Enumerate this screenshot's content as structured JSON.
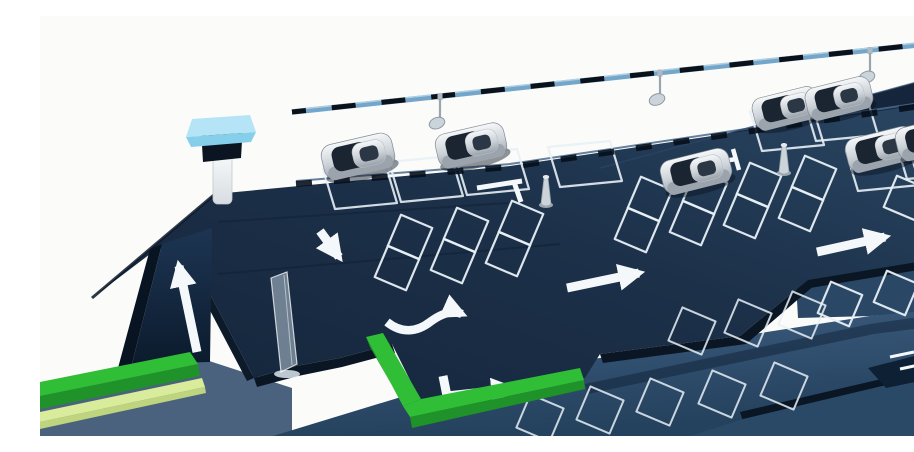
{
  "scene": {
    "name": "3d-parking-facility-illustration",
    "width": 914,
    "height": 420,
    "colors": {
      "bg": "#fbfbf9",
      "deck_face": "#0a1624",
      "marking": "#f4f8fb",
      "space_stroke": "#e8f0f6",
      "rail_bar": "#74a6ca",
      "rail_highlight": "#b6d4e8",
      "rail_dash": "#0b1119",
      "fixture_metal": "#ccd4db",
      "fixture_stroke": "#8e99a3",
      "kiosk_cap": "#b5e4f6",
      "kiosk_cap_rim": "#86cfeb",
      "kiosk_screen": "#0b1522",
      "bollard_body": "#ccd3d9",
      "bollard_stroke": "#99a3ad",
      "car_glass": "#1a2531",
      "car_skirt": "#9ba3ac",
      "curb_green": "#2fbe36",
      "curb_green_dark": "#1f9229",
      "curb_stripe": "#d9ec9b",
      "curb_stripe_dark": "#bed47e",
      "glass_gate": "rgba(214,232,244,0.45)"
    },
    "polygons": [
      {
        "name": "ground-slab",
        "fill": "#4a627d",
        "pts": [
          [
            0,
            376
          ],
          [
            160,
            342
          ],
          [
            252,
            372
          ],
          [
            252,
            420
          ],
          [
            0,
            420
          ]
        ]
      },
      {
        "name": "lower-deck",
        "fill": "g:glower",
        "pts": [
          [
            233,
            420
          ],
          [
            430,
            360
          ],
          [
            560,
            342
          ],
          [
            830,
            300
          ],
          [
            914,
            290
          ],
          [
            914,
            420
          ]
        ]
      },
      {
        "name": "deck-shadow",
        "fill": "#0d1d30",
        "opacity": 0.45,
        "pts": [
          [
            545,
            368
          ],
          [
            830,
            308
          ],
          [
            914,
            296
          ],
          [
            914,
            308
          ],
          [
            834,
            318
          ],
          [
            548,
            378
          ]
        ]
      },
      {
        "name": "lower-front-band",
        "fill": "#0a1624",
        "pts": [
          [
            700,
            396
          ],
          [
            914,
            346
          ],
          [
            914,
            355
          ],
          [
            703,
            405
          ]
        ]
      },
      {
        "name": "lower-bottom-deck",
        "fill": "#2a4967",
        "pts": [
          [
            650,
            420
          ],
          [
            703,
            403
          ],
          [
            914,
            353
          ],
          [
            914,
            420
          ]
        ]
      },
      {
        "name": "bottom-right-wedge",
        "fill": "#0e2034",
        "pts": [
          [
            828,
            352
          ],
          [
            913,
            330
          ],
          [
            914,
            358
          ],
          [
            846,
            372
          ]
        ]
      },
      {
        "name": "mid-right-deck",
        "fill": "#2a4765",
        "pts": [
          [
            756,
            266
          ],
          [
            914,
            236
          ],
          [
            914,
            292
          ],
          [
            830,
            300
          ],
          [
            758,
            302
          ]
        ]
      },
      {
        "name": "back-deck-strip",
        "fill": "#15263c",
        "pts": [
          [
            560,
            152
          ],
          [
            914,
            56
          ],
          [
            914,
            98
          ],
          [
            560,
            194
          ]
        ]
      },
      {
        "name": "upper-deck",
        "fill": "g:gdeck",
        "pts": [
          [
            52,
            282
          ],
          [
            175,
            178
          ],
          [
            470,
            150
          ],
          [
            914,
            84
          ],
          [
            914,
            240
          ],
          [
            838,
            256
          ],
          [
            768,
            264
          ],
          [
            700,
            320
          ],
          [
            560,
            338
          ],
          [
            545,
            362
          ],
          [
            388,
            400
          ],
          [
            352,
            328
          ],
          [
            300,
            342
          ],
          [
            256,
            350
          ],
          [
            214,
            362
          ],
          [
            150,
            240
          ],
          [
            118,
            232
          ]
        ]
      },
      {
        "name": "deck-face-a",
        "fill": "#0a1624",
        "pts": [
          [
            214,
            362
          ],
          [
            256,
            350
          ],
          [
            300,
            342
          ],
          [
            352,
            328
          ],
          [
            355,
            337
          ],
          [
            302,
            351
          ],
          [
            258,
            360
          ],
          [
            217,
            371
          ]
        ]
      },
      {
        "name": "deck-face-b",
        "fill": "#0a1624",
        "pts": [
          [
            560,
            338
          ],
          [
            700,
            320
          ],
          [
            768,
            264
          ],
          [
            776,
            268
          ],
          [
            706,
            328
          ],
          [
            563,
            347
          ]
        ]
      },
      {
        "name": "deck-face-c",
        "fill": "#0a1624",
        "pts": [
          [
            768,
            264
          ],
          [
            914,
            240
          ],
          [
            914,
            248
          ],
          [
            770,
            272
          ]
        ]
      },
      {
        "name": "gate-slab-edge",
        "fill": "#0c1a2a",
        "pts": [
          [
            150,
            240
          ],
          [
            214,
            362
          ],
          [
            207,
            365
          ],
          [
            143,
            243
          ]
        ]
      },
      {
        "name": "ramp-side",
        "fill": "#091423",
        "pts": [
          [
            92,
            348
          ],
          [
            122,
            228
          ],
          [
            110,
            233
          ],
          [
            78,
            352
          ]
        ]
      },
      {
        "name": "ramp",
        "fill": "g:gramp",
        "pts": [
          [
            92,
            348
          ],
          [
            122,
            228
          ],
          [
            172,
            212
          ],
          [
            170,
            346
          ]
        ]
      }
    ],
    "lines": [
      {
        "name": "left-edge-shadow",
        "d": "M52,282 L175,178",
        "stroke": "#0c1a2a",
        "w": 3,
        "opacity": 0.85
      },
      {
        "name": "deck-seam-1",
        "d": "M178,258 L520,228",
        "stroke": "#0f2033",
        "w": 2,
        "opacity": 0.55
      },
      {
        "name": "deck-seam-2",
        "d": "M178,206 L468,187",
        "stroke": "#0f2033",
        "w": 2,
        "opacity": 0.5
      },
      {
        "name": "deck-edge-rim",
        "d": "M256,165 L470,148 L914,82",
        "stroke": "#4a6b8d",
        "w": 2,
        "opacity": 0.85
      },
      {
        "name": "back-strip-rim",
        "d": "M560,152 L914,56",
        "stroke": "#2c4668",
        "w": 1.5,
        "opacity": 0.7
      }
    ],
    "edge_dashes": {
      "d": "M256,168 L470,151 L914,85",
      "stroke": "#06101c",
      "w": 6,
      "dash": "16 22"
    },
    "rail": {
      "x1": 252,
      "y1": 96,
      "x2": 914,
      "y2": 25,
      "fixture_x": [
        400,
        620,
        830
      ]
    },
    "spaces_top": {
      "u": [
        31,
        -3
      ],
      "v": [
        6,
        20
      ],
      "centers": [
        [
          320,
          170
        ],
        [
          386,
          163
        ],
        [
          452,
          156
        ],
        [
          545,
          148
        ],
        [
          747,
          112
        ],
        [
          801,
          102
        ],
        [
          843,
          152
        ],
        [
          892,
          140
        ]
      ]
    },
    "spaces_diamond": {
      "side": 34,
      "rot": 23,
      "centers": [
        [
          370,
          221
        ],
        [
          426,
          214
        ],
        [
          481,
          207
        ],
        [
          357,
          252
        ],
        [
          413,
          245
        ],
        [
          468,
          238
        ],
        [
          610,
          183
        ],
        [
          665,
          176
        ],
        [
          719,
          169
        ],
        [
          774,
          162
        ],
        [
          597,
          214
        ],
        [
          652,
          207
        ],
        [
          706,
          200
        ],
        [
          761,
          193
        ],
        [
          866,
          182
        ],
        [
          800,
          288
        ],
        [
          856,
          277
        ],
        [
          902,
          264
        ]
      ]
    },
    "spaces_lower": {
      "side": 36,
      "rot": 23,
      "centers": [
        [
          652,
          315
        ],
        [
          708,
          307
        ],
        [
          762,
          299
        ],
        [
          500,
          402
        ],
        [
          560,
          394
        ],
        [
          620,
          386
        ],
        [
          682,
          378
        ],
        [
          744,
          370
        ]
      ]
    },
    "arrows": [
      {
        "name": "ramp-up-arrow",
        "d": "M157,336 L139,250",
        "w": 9
      },
      {
        "name": "down-arrow",
        "d": "M280,215 L299,241",
        "w": 9
      },
      {
        "name": "s-curve-arrow",
        "d": "M347,306 C362,318 377,316 390,306 C402,297 413,294 422,298",
        "w": 8.5
      },
      {
        "name": "right-arrow-mid",
        "d": "M527,272 L599,257",
        "w": 9
      },
      {
        "name": "right-arrow-upper",
        "d": "M777,236 L845,221",
        "w": 9
      },
      {
        "name": "corner-turn-arrow",
        "d": "M403,360 L407,380 L472,373",
        "w": 9
      }
    ],
    "marks": [
      {
        "name": "t-mark-bar",
        "d": "M437,172 L482,165",
        "w": 5
      },
      {
        "name": "t-mark-stem",
        "d": "M474,166 L481,186",
        "w": 5
      },
      {
        "name": "t-mark2-bar",
        "d": "M668,147 L697,143",
        "w": 4.5
      },
      {
        "name": "t-mark2-stem",
        "d": "M693,133 L699,154",
        "w": 4.5
      },
      {
        "name": "wedge-line-1",
        "d": "M850,341 L874,336",
        "w": 3
      },
      {
        "name": "wedge-line-2",
        "d": "M860,353 L888,347",
        "w": 3
      },
      {
        "name": "corner-line-1",
        "d": "M884,398 L912,391",
        "w": 3
      },
      {
        "name": "corner-line-2",
        "d": "M878,411 L908,404",
        "w": 3
      }
    ],
    "curb_left": {
      "top": [
        [
          0,
          366
        ],
        [
          150,
          336
        ],
        [
          158,
          348
        ],
        [
          0,
          380
        ]
      ],
      "front": [
        [
          0,
          380
        ],
        [
          158,
          348
        ],
        [
          160,
          360
        ],
        [
          0,
          393
        ]
      ],
      "stripe": [
        [
          0,
          396
        ],
        [
          162,
          362
        ],
        [
          165,
          371
        ],
        [
          0,
          406
        ]
      ],
      "stripe_front": [
        [
          0,
          406
        ],
        [
          165,
          371
        ],
        [
          166,
          377
        ],
        [
          0,
          413
        ]
      ]
    },
    "curb_corner": {
      "legA": [
        [
          326,
          321
        ],
        [
          343,
          317
        ],
        [
          381,
          383
        ],
        [
          363,
          390
        ]
      ],
      "legB": [
        [
          363,
          390
        ],
        [
          381,
          383
        ],
        [
          540,
          352
        ],
        [
          544,
          364
        ],
        [
          370,
          401
        ]
      ],
      "front": [
        [
          370,
          401
        ],
        [
          544,
          364
        ],
        [
          545,
          373
        ],
        [
          372,
          412
        ]
      ],
      "side": [
        [
          326,
          321
        ],
        [
          330,
          331
        ],
        [
          370,
          401
        ],
        [
          363,
          390
        ]
      ]
    },
    "gate": {
      "panel": [
        [
          231,
          262
        ],
        [
          247,
          256
        ],
        [
          257,
          348
        ],
        [
          241,
          356
        ]
      ],
      "inner": "M244,259 L252,349",
      "glow": [
        247,
        358,
        13,
        4
      ]
    },
    "kiosk": {
      "post": [
        173,
        138,
        19,
        50
      ],
      "screen": [
        [
          161,
          112
        ],
        [
          203,
          108
        ],
        [
          201,
          142
        ],
        [
          163,
          146
        ]
      ],
      "cap_top": [
        [
          152,
          103
        ],
        [
          210,
          99
        ],
        [
          216,
          116
        ],
        [
          146,
          121
        ]
      ],
      "cap_rim": [
        [
          146,
          121
        ],
        [
          216,
          116
        ],
        [
          211,
          126
        ],
        [
          151,
          131
        ]
      ]
    },
    "bollards": [
      [
        506,
        188
      ],
      [
        744,
        156
      ]
    ],
    "cars": [
      {
        "x": 318,
        "y": 140,
        "r": -13,
        "s": 1.03
      },
      {
        "x": 431,
        "y": 129,
        "r": -13,
        "s": 1.0
      },
      {
        "x": 656,
        "y": 155,
        "r": -14,
        "s": 1.0
      },
      {
        "x": 746,
        "y": 92,
        "r": -14,
        "s": 0.95
      },
      {
        "x": 799,
        "y": 82,
        "r": -14,
        "s": 0.95
      },
      {
        "x": 841,
        "y": 133,
        "r": -14,
        "s": 1.0
      },
      {
        "x": 890,
        "y": 122,
        "r": -14,
        "s": 0.97
      }
    ]
  }
}
